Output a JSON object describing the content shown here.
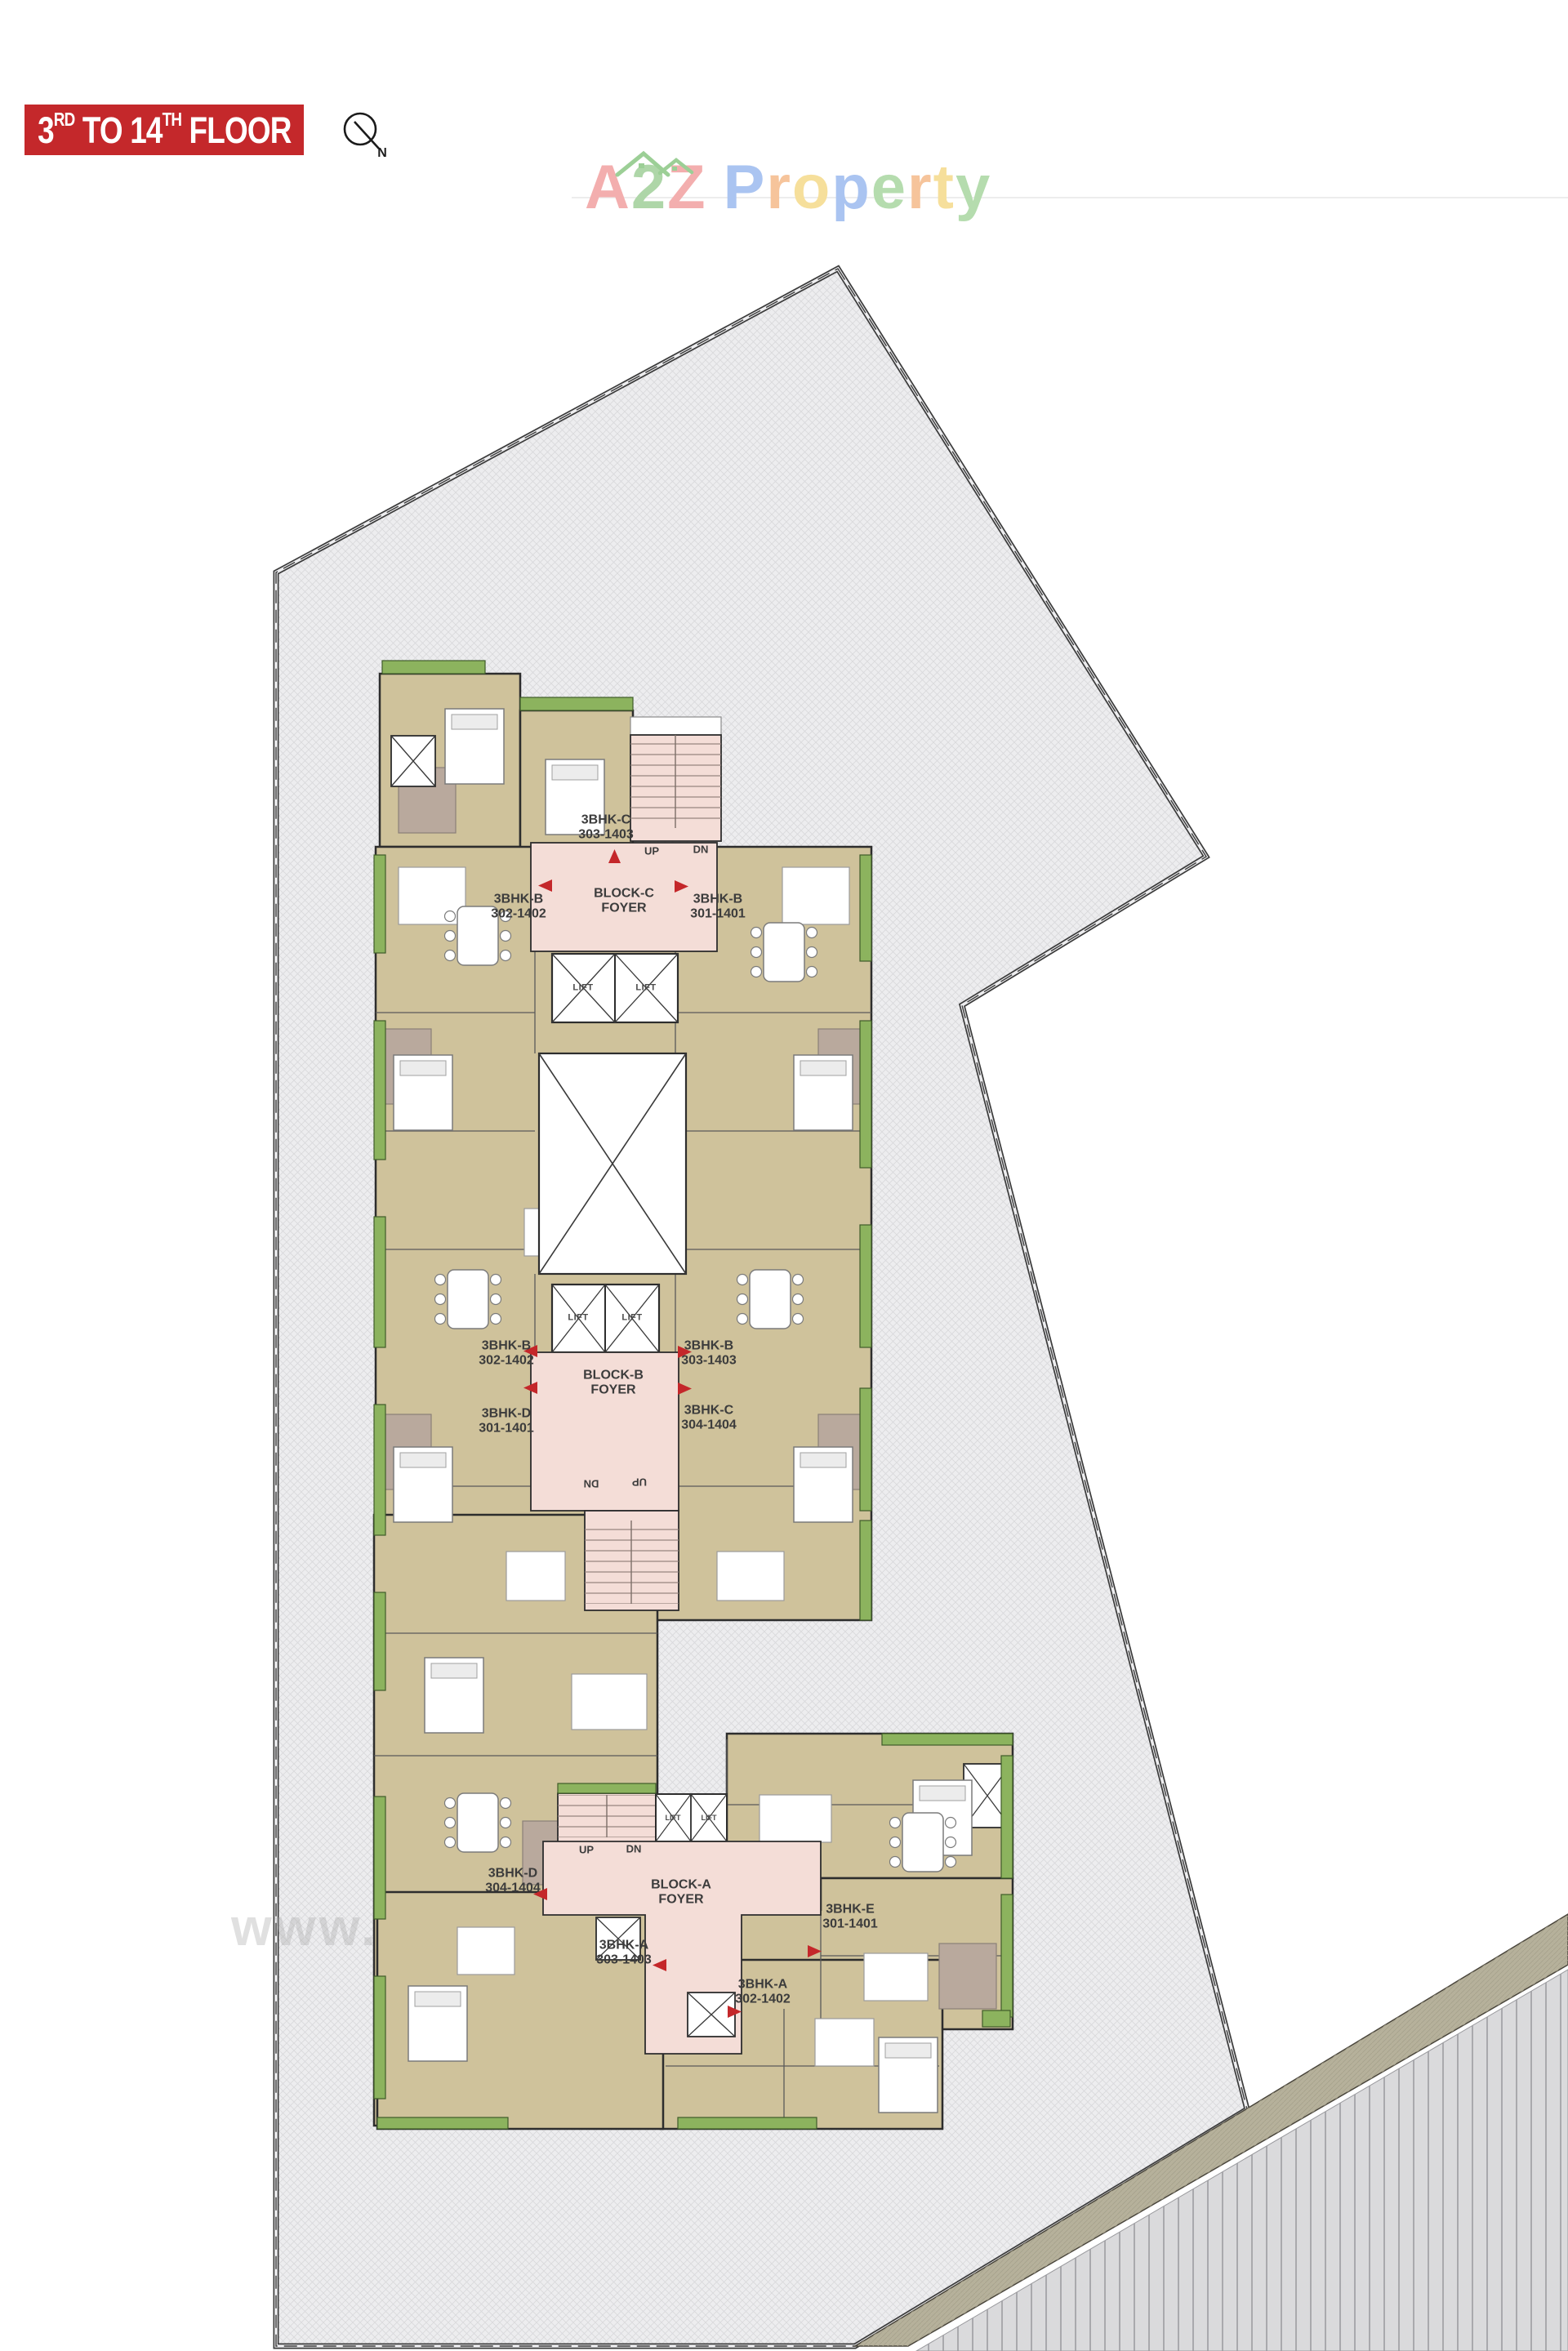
{
  "header": {
    "floor_prefix": "3",
    "floor_prefix_sup": "RD",
    "floor_mid": " TO 14",
    "floor_mid_sup": "TH",
    "floor_suffix": " FLOOR",
    "north": "N"
  },
  "logo": {
    "name": "A2Z Property",
    "letters": [
      "A",
      "2",
      "Z",
      "P",
      "r",
      "o",
      "p",
      "e",
      "r",
      "t",
      "y"
    ]
  },
  "watermark": "www.A2ZProperty.in",
  "colors": {
    "banner_red": "#c4282b",
    "arrow_red": "#c4272a",
    "room_tan": "#cfc29b",
    "balcony_green": "#8cb35e",
    "foyer_pink": "#f4ddd7",
    "wall_dark": "#2d2d2d",
    "site_fill": "#ededef",
    "site_line": "#3b3b3b",
    "road_band": "#b6b19b",
    "logo_palette": {
      "red": "#f3aeae",
      "green": "#aed6a8",
      "blue": "#aac4f1",
      "orange": "#f6c49b",
      "yellow": "#f6df9b",
      "leaf": "#b5dcae"
    }
  },
  "plan": {
    "foyers": [
      {
        "l1": "BLOCK-C",
        "l2": "FOYER"
      },
      {
        "l1": "BLOCK-B",
        "l2": "FOYER"
      },
      {
        "l1": "BLOCK-A",
        "l2": "FOYER"
      }
    ],
    "units": [
      {
        "t": "3BHK-C",
        "n": "303-1403"
      },
      {
        "t": "3BHK-B",
        "n": "302-1402"
      },
      {
        "t": "3BHK-B",
        "n": "301-1401"
      },
      {
        "t": "3BHK-B",
        "n": "302-1402"
      },
      {
        "t": "3BHK-B",
        "n": "303-1403"
      },
      {
        "t": "3BHK-D",
        "n": "301-1401"
      },
      {
        "t": "3BHK-C",
        "n": "304-1404"
      },
      {
        "t": "3BHK-D",
        "n": "304-1404"
      },
      {
        "t": "3BHK-E",
        "n": "301-1401"
      },
      {
        "t": "3BHK-A",
        "n": "303-1403"
      },
      {
        "t": "3BHK-A",
        "n": "302-1402"
      }
    ],
    "stairs": [
      "UP",
      "DN",
      "DN",
      "UP",
      "UP",
      "DN"
    ],
    "lifts": [
      "LIFT",
      "LIFT",
      "LIFT",
      "LIFT",
      "LIFT",
      "LIFT"
    ]
  }
}
